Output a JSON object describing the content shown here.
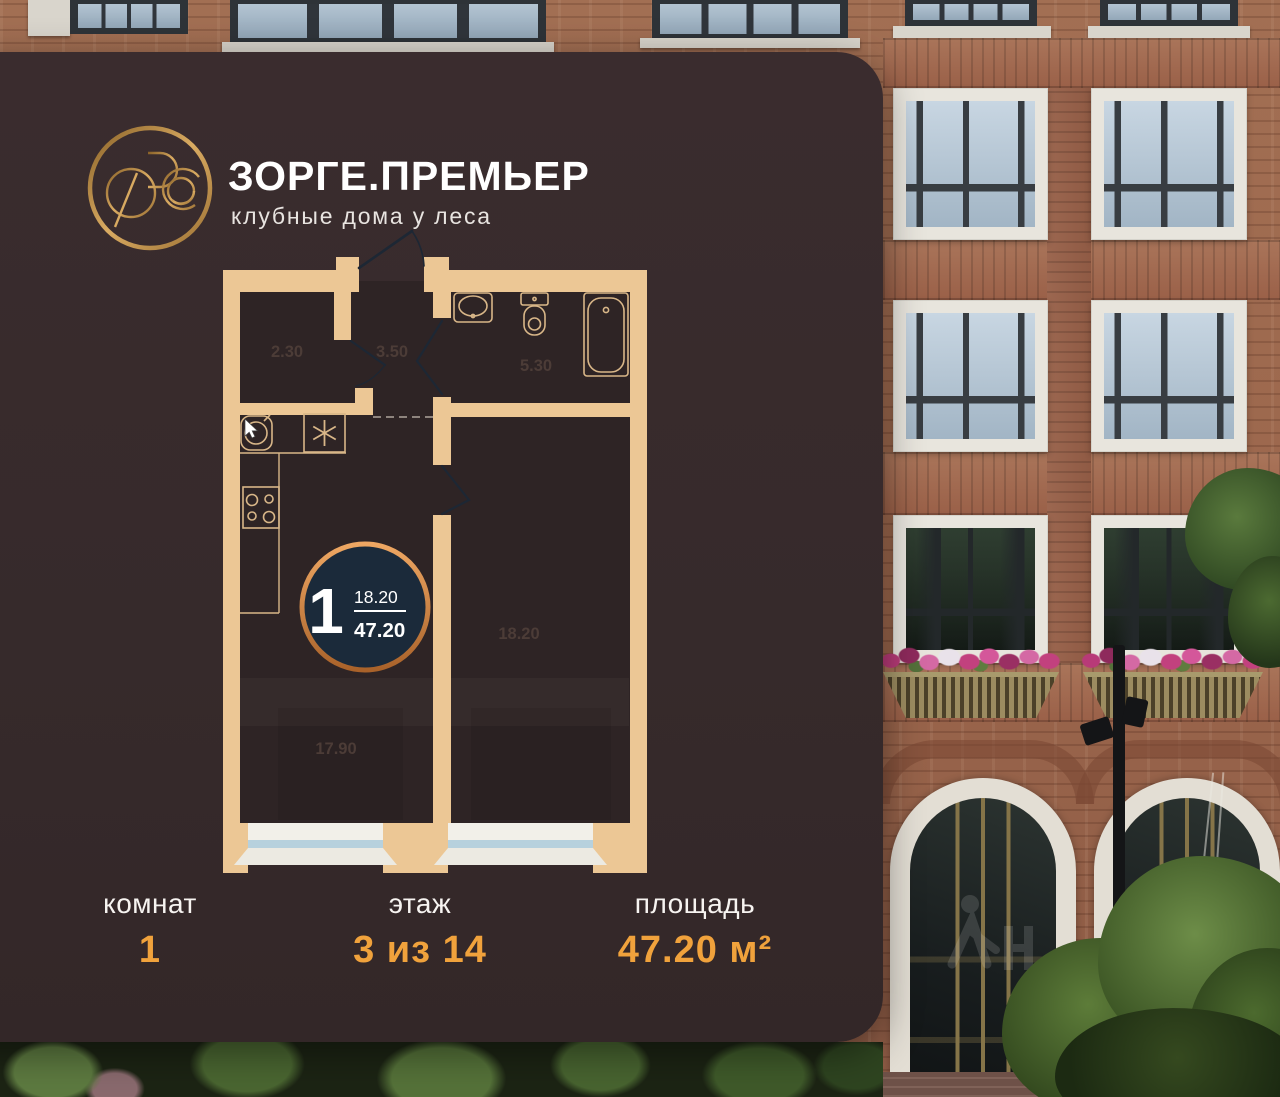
{
  "brand": {
    "title": "ЗОРГЕ.ПРЕМЬЕР",
    "subtitle": "клубные дома у леса",
    "logo_icon": "zorge-monogram-emblem"
  },
  "floor_plan": {
    "badge": {
      "rooms_count": "1",
      "living_area": "18.20",
      "total_area": "47.20"
    },
    "rooms": [
      {
        "name": "closet",
        "area_label": "2.30"
      },
      {
        "name": "hallway",
        "area_label": "3.50"
      },
      {
        "name": "bathroom",
        "area_label": "5.30"
      },
      {
        "name": "kitchen-living-room",
        "area_label": "17.90"
      },
      {
        "name": "bedroom",
        "area_label": "18.20"
      }
    ],
    "icons": [
      "entrance-door-icon",
      "bath-sink-icon",
      "toilet-icon",
      "bathtub-icon",
      "kitchen-sink-icon",
      "fridge-snowflake-icon",
      "stove-icon",
      "mouse-cursor-icon"
    ]
  },
  "summary": {
    "rooms": {
      "label": "комнат",
      "value": "1"
    },
    "floor": {
      "label": "этаж",
      "value": "3 из 14"
    },
    "area": {
      "label": "площадь",
      "value": "47.20 м²"
    }
  },
  "colors": {
    "card_background": "#372a2b",
    "plan_wall": "#ecc795",
    "accent_amber": "#f0a23c",
    "badge_navy": "#1b2a3a",
    "badge_ring_copper": "#c98548",
    "door_line_navy": "#1d2734",
    "window_glass_blue": "#b7d1dd"
  }
}
